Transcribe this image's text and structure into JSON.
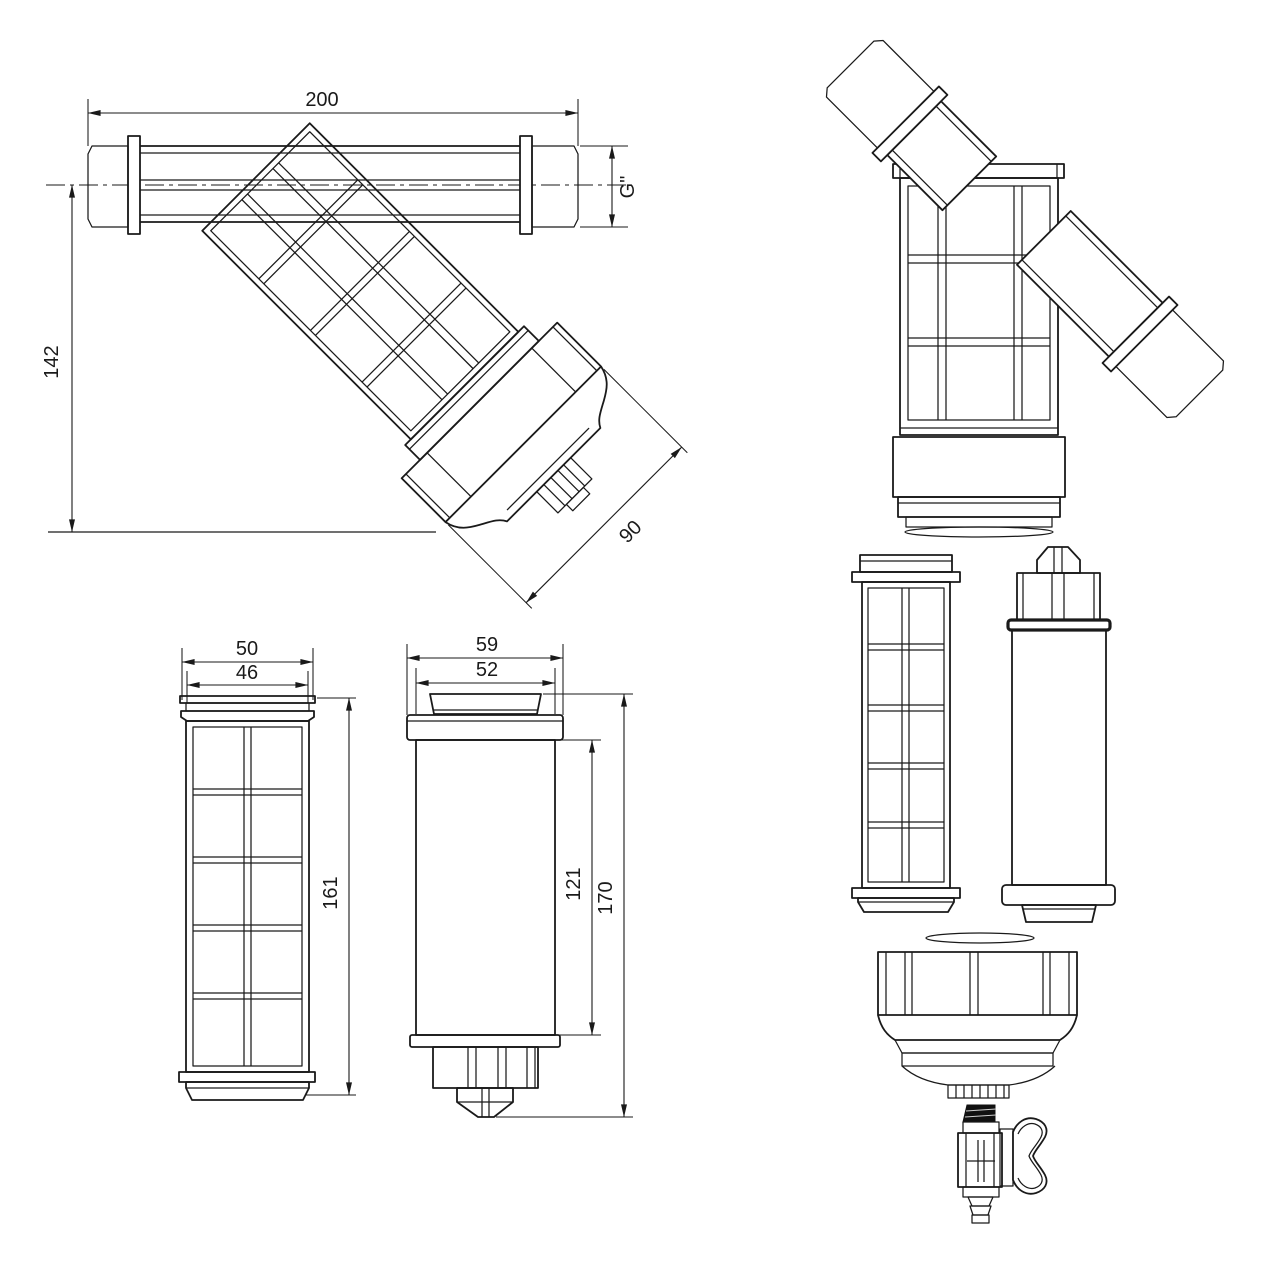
{
  "dims": {
    "side": {
      "length": "200",
      "height": "142",
      "cap": "90",
      "thread": "G\""
    },
    "screen": {
      "outer": "50",
      "inner": "46",
      "height": "161"
    },
    "bowl": {
      "outer": "59",
      "inner": "52",
      "body": "121",
      "total": "170"
    }
  },
  "colors": {
    "line": "#1a1a1a",
    "thread_light": "#cccccc",
    "thread_dark": "#676767",
    "coarse_thread_gray": "#bdbdbd",
    "valve_nipple": "#111111",
    "background": "#ffffff"
  },
  "parts": {
    "assembly": "y-filter-side-view",
    "rotated": "y-filter-rotated-view",
    "screen": "filter-screen-cartridge",
    "bowl": "filter-bowl",
    "exploded": [
      "o-ring",
      "screen-cartridge",
      "filter-bowl",
      "o-ring",
      "ring-nut-cap",
      "drain-valve"
    ]
  }
}
